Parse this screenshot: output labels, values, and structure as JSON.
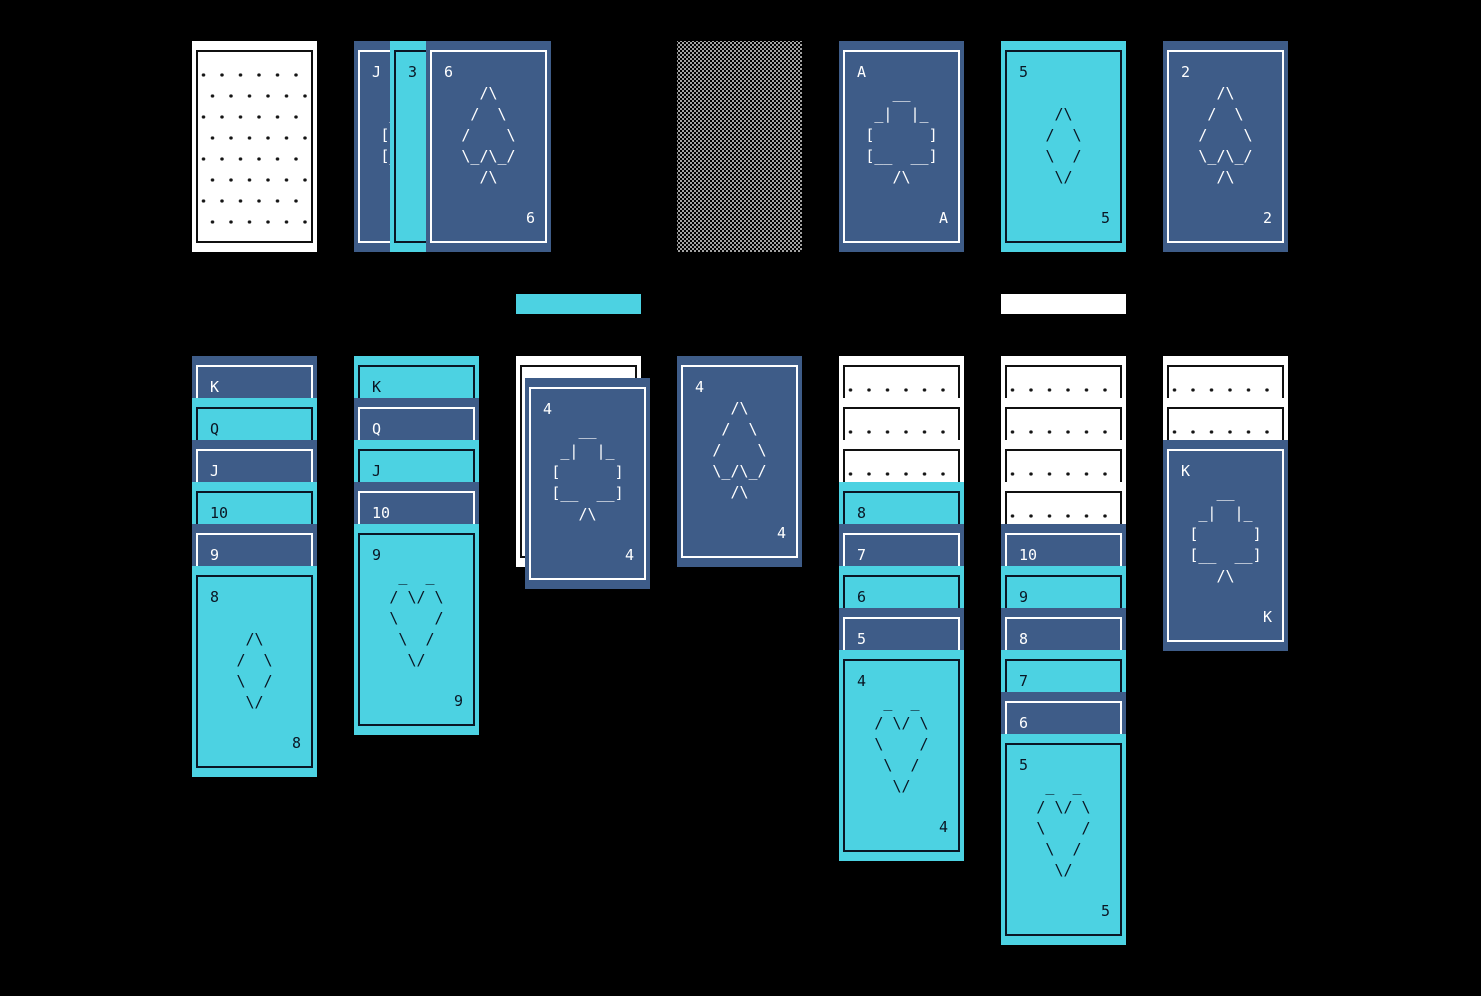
{
  "palette": {
    "background": "#000000",
    "card_blue": "#3e5c88",
    "card_cyan": "#4cd2e2",
    "card_white": "#ffffff",
    "ink_dark": "#0a1624"
  },
  "suit_art": {
    "spades": [
      "  /\\  ",
      " /  \\ ",
      "/    \\",
      "\\_/\\_/",
      "  /\\  "
    ],
    "hearts": [
      " _  _ ",
      "/ \\/ \\",
      "\\    /",
      " \\  / ",
      "  \\/  "
    ],
    "diamonds": [
      " /\\ ",
      "/  \\",
      "\\  /",
      " \\/ "
    ],
    "clubs": [
      "   __   ",
      " _|  |_ ",
      "[      ]",
      "[__  __]",
      "   /\\   "
    ]
  },
  "stock": {
    "cards": [
      {
        "facedown": true
      }
    ]
  },
  "waste": {
    "cards": [
      {
        "rank": "J",
        "suit": "clubs",
        "color": "blue"
      },
      {
        "rank": "3",
        "color": "cyan"
      },
      {
        "rank": "6",
        "suit": "spades",
        "color": "blue"
      }
    ]
  },
  "foundations": [
    {
      "empty": true
    },
    {
      "rank": "A",
      "suit": "clubs",
      "color": "blue"
    },
    {
      "rank": "5",
      "suit": "diamonds",
      "color": "cyan"
    },
    {
      "rank": "2",
      "suit": "spades",
      "color": "blue"
    }
  ],
  "indicator_bars": [
    {
      "id": "cyan-bar",
      "color": "#4cd2e2"
    },
    {
      "id": "white-bar",
      "color": "#ffffff"
    }
  ],
  "tableau": [
    {
      "cards": [
        {
          "rank": "K",
          "color": "blue"
        },
        {
          "rank": "Q",
          "color": "cyan"
        },
        {
          "rank": "J",
          "color": "blue"
        },
        {
          "rank": "10",
          "color": "cyan"
        },
        {
          "rank": "9",
          "color": "blue"
        },
        {
          "rank": "8",
          "suit": "diamonds",
          "color": "cyan"
        }
      ]
    },
    {
      "cards": [
        {
          "rank": "K",
          "color": "cyan"
        },
        {
          "rank": "Q",
          "color": "blue"
        },
        {
          "rank": "J",
          "color": "cyan"
        },
        {
          "rank": "10",
          "color": "blue"
        },
        {
          "rank": "9",
          "suit": "hearts",
          "color": "cyan"
        }
      ]
    },
    {
      "cards": [
        {
          "facedown": true
        },
        {
          "rank": "4",
          "suit": "clubs",
          "color": "blue",
          "corner_offset": true
        }
      ]
    },
    {
      "cards": [
        {
          "rank": "4",
          "suit": "spades",
          "color": "blue"
        }
      ]
    },
    {
      "cards": [
        {
          "facedown": true
        },
        {
          "facedown": true
        },
        {
          "facedown": true
        },
        {
          "rank": "8",
          "color": "cyan"
        },
        {
          "rank": "7",
          "color": "blue"
        },
        {
          "rank": "6",
          "color": "cyan"
        },
        {
          "rank": "5",
          "color": "blue"
        },
        {
          "rank": "4",
          "suit": "hearts",
          "color": "cyan"
        }
      ]
    },
    {
      "cards": [
        {
          "facedown": true
        },
        {
          "facedown": true
        },
        {
          "facedown": true
        },
        {
          "facedown": true
        },
        {
          "rank": "10",
          "color": "blue"
        },
        {
          "rank": "9",
          "color": "cyan"
        },
        {
          "rank": "8",
          "color": "blue"
        },
        {
          "rank": "7",
          "color": "cyan"
        },
        {
          "rank": "6",
          "color": "blue"
        },
        {
          "rank": "5",
          "suit": "hearts",
          "color": "cyan"
        }
      ]
    },
    {
      "cards": [
        {
          "facedown": true
        },
        {
          "facedown": true
        },
        {
          "rank": "K",
          "suit": "clubs",
          "color": "blue"
        }
      ]
    }
  ]
}
